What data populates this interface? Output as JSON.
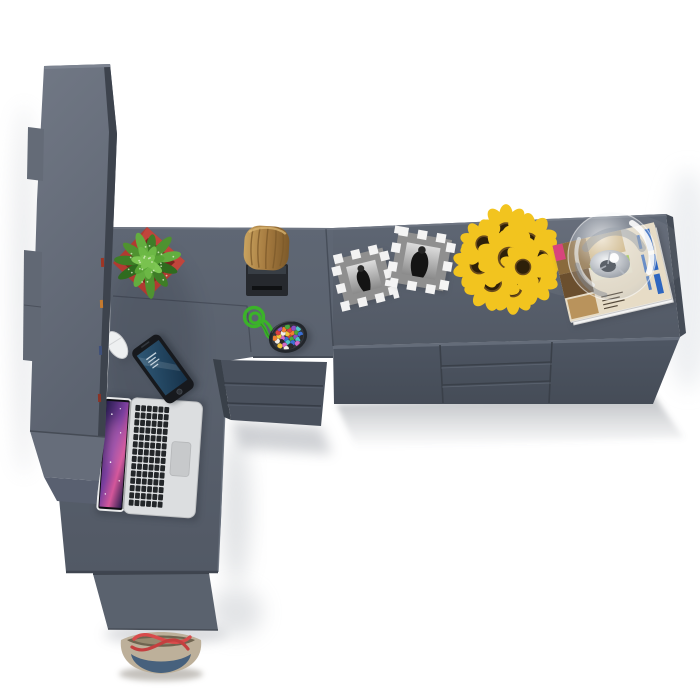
{
  "scene": {
    "title": "Top-down 3D render of an L-shaped office desk with hutch and sideboard",
    "view": "bird's-eye product render, no visible text",
    "background": "#ffffff"
  },
  "palette": {
    "floor_white": "#ffffff",
    "desk_top_light": "#5f6774",
    "desk_top_dark": "#525965",
    "desk_front": "#4e5663",
    "desk_front_dark": "#454c57",
    "panel_front": "#5a626e",
    "hutch_light": "#717885",
    "hutch_dark": "#5c6370",
    "hutch_edge": "#3d434d",
    "drawer_front": "#4a515d",
    "side_edge": "#454c57",
    "pot_red": "#b13a31",
    "pot_red_dark": "#7e241e",
    "leaf_green": "#4f9230",
    "log_brown": "#a57a3f",
    "log_light": "#c9a35f",
    "log_dark": "#7d5a2a",
    "stand_black": "#26292e",
    "rope_green": "#3bb329",
    "bowl_dark": "#22262b",
    "bowl_inner": "#34383e",
    "frame_silver": "#f2f2f2",
    "frame_gray": "#8f8f8f",
    "photo_light": "#dcdcdc",
    "photo_dark": "#141414",
    "sunflower_yellow": "#f2c41f",
    "sunflower_center": "#2e2009",
    "bouquet_green": "#41652e",
    "filler_white": "#eceae2",
    "mag_paper": "#e7dcc6",
    "mag_blue": "#2e66c0",
    "mag_brown": "#8a6a3c",
    "mag_tan": "#c9a86a",
    "mag_green": "#9bc24a",
    "mag_pink": "#d8447c",
    "glass_silver": "#9aa1ab",
    "silver_light": "#f2f4f6",
    "silver_dark": "#8d939c",
    "laptop_silver": "#dcdee0",
    "key_black": "#232629",
    "trackpad_gray": "#c7c9cb",
    "galaxy_dark": "#271c4e",
    "galaxy_purple": "#7a3f9e",
    "galaxy_pink": "#d4579a",
    "phone_body": "#17191d",
    "phone_screen": "#2f5876",
    "phone_screen_dark": "#16324a",
    "mouse_white": "#eef0f1",
    "bag_beige": "#bdb09a",
    "bag_inner": "#6f6450",
    "bag_denim": "#47617d",
    "strap_red": "#d84b4b",
    "candy_colors": [
      "#d94040",
      "#3b6fd4",
      "#f2c53d",
      "#49a53f",
      "#d069c8",
      "#f08030",
      "#4fc3c7",
      "#f5f0e8",
      "#8a4fc3",
      "#2b2b2b"
    ]
  },
  "objects": [
    {
      "name": "hutch-bookcase",
      "desc": "tall gray storage hutch seen from above, left side"
    },
    {
      "name": "l-shaped-desk",
      "desc": "L-shaped gray desk surface"
    },
    {
      "name": "sideboard",
      "desc": "long sideboard with two doors and three center drawers"
    },
    {
      "name": "corner-drawer-unit",
      "desc": "three-drawer pedestal under the corner desk"
    },
    {
      "name": "potted-plant",
      "desc": "speckled green plant in a red square pot"
    },
    {
      "name": "wooden-log-stool",
      "desc": "wooden log on a black stand"
    },
    {
      "name": "green-rope",
      "desc": "green cord with a loop and knots"
    },
    {
      "name": "candy-bowl",
      "desc": "dark bowl filled with multicolored candies"
    },
    {
      "name": "picture-frames",
      "desc": "two black-and-white photos in silver checkered frames"
    },
    {
      "name": "sunflower-bouquet",
      "desc": "bouquet of sunflowers viewed from above"
    },
    {
      "name": "glass-dome-lamp",
      "desc": "glass sphere lamp sitting on magazines"
    },
    {
      "name": "magazines",
      "desc": "stack of magazines with blue spine lettering"
    },
    {
      "name": "laptop",
      "desc": "open silver laptop with purple galaxy wallpaper"
    },
    {
      "name": "smartphone",
      "desc": "black smartphone with a blue lock screen"
    },
    {
      "name": "computer-mouse",
      "desc": "white mouse at the desk edge"
    },
    {
      "name": "tote-bag",
      "desc": "canvas tote bag with denim panel and red straps on the floor"
    }
  ]
}
